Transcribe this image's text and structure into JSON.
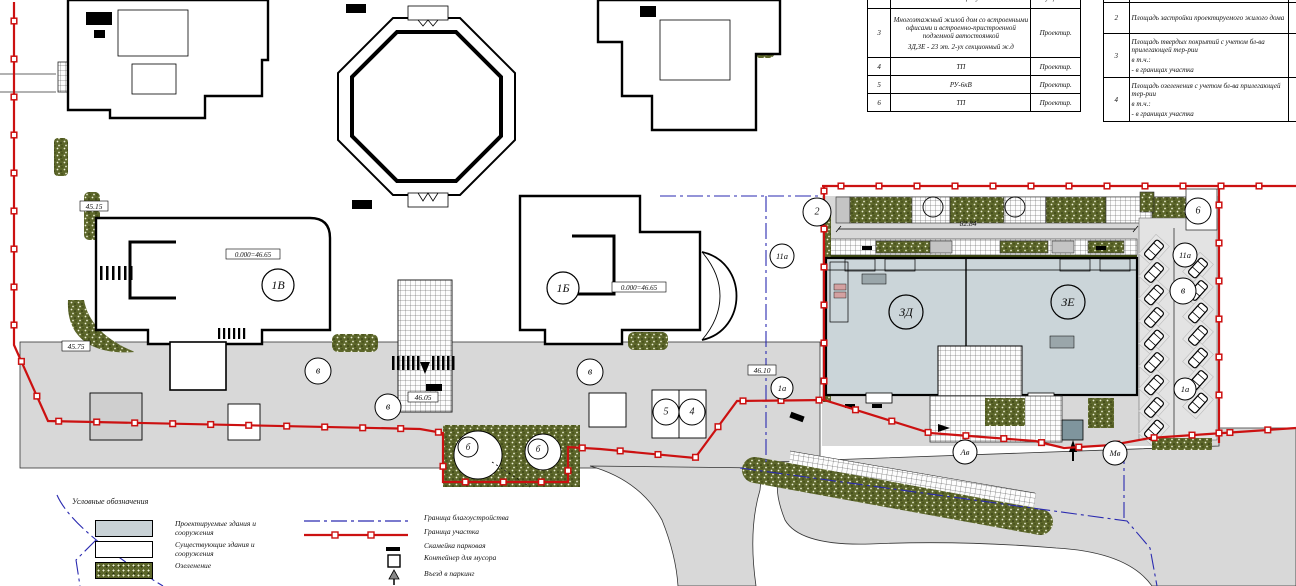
{
  "drawing": {
    "tables": {
      "buildings": {
        "rows": [
          {
            "num": "2",
            "name": "биологического факультетов",
            "status": "Существ."
          },
          {
            "num": "3",
            "name": "Многоэтажный жилой дом со встроенными офисами и встроенно-пристроенной подземной автостоянкой",
            "name2": "ЗД,ЗЕ - 23 эт. 2-ух секционный  ж.д",
            "status": "Проектир."
          },
          {
            "num": "4",
            "name": "ТП",
            "status": "Проектир."
          },
          {
            "num": "5",
            "name": "РУ-6кВ",
            "status": "Проектир."
          },
          {
            "num": "6",
            "name": "ТП",
            "status": "Проектир."
          }
        ]
      },
      "areas": {
        "rows": [
          {
            "num": "2",
            "name": "Площадь застройки проектируемого жилого дома",
            "sub": "",
            "sub2": ""
          },
          {
            "num": "3",
            "name": "Площадь твердых покрытий с учетом бл-ва прилегающей тер-рии",
            "sub": "в т.ч.:",
            "sub2": "- в границах участка"
          },
          {
            "num": "4",
            "name": "Площадь озеленения с учетом бл-ва прилегающей тер-рии",
            "sub": "в т.ч.:",
            "sub2": "- в границах участка"
          }
        ]
      }
    },
    "legend": {
      "title": "Условные обозначения",
      "swatches": [
        {
          "label": "Проектируемые здания и сооружения"
        },
        {
          "label": "Существующие здания и сооружения"
        },
        {
          "label": "Озеленение"
        }
      ],
      "lines": [
        {
          "label": "Граница благоустройства"
        },
        {
          "label": "Граница участка"
        },
        {
          "label": "Скамейка парковая"
        },
        {
          "label": "Контейнер для мусора"
        },
        {
          "label": "Въезд в паркинг"
        }
      ]
    },
    "callouts": {
      "b1v": "1В",
      "b1b": "1Б",
      "b3d": "ЗД",
      "b3e": "ЗЕ",
      "n2": "2",
      "n6": "6",
      "n11a_r": "11а",
      "nv_r": "в",
      "n1a_r": "1а",
      "n11a_l": "11а",
      "n1a_l": "1а",
      "v1": "в",
      "v2": "в",
      "v3": "в",
      "n5": "5",
      "n4": "4",
      "pb1": "б",
      "pb2": "б",
      "av": "Ав",
      "mv": "Мв"
    },
    "elevations": {
      "e1": "45.15",
      "e2": "45.75",
      "e3": "46.05",
      "e4": "46.10",
      "z1": "0.000=46.65",
      "z2": "0.000=46.65"
    },
    "dimensions": {
      "d1": "82.84"
    },
    "colors": {
      "boundary": "#cc1111",
      "improvement": "#2a2ab0",
      "proposed_fill": "#cbd5d9",
      "road": "#d8d8d8",
      "green": "#5c662a"
    }
  }
}
